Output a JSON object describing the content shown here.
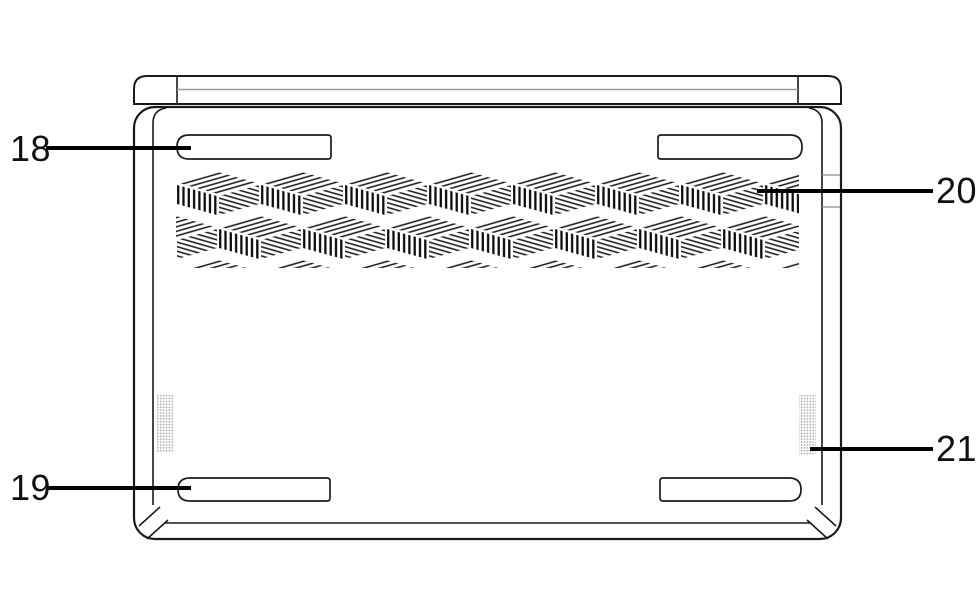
{
  "diagram": {
    "callouts": [
      {
        "label": "18"
      },
      {
        "label": "19"
      },
      {
        "label": "20"
      },
      {
        "label": "21"
      }
    ],
    "colors": {
      "outline": "#1a1a1a",
      "leader_line": "#000000",
      "lid_seam_gray": "#999999",
      "edge_tick_gray": "#8c8c8c",
      "speaker_dot_gray": "#a8a8a8",
      "background": "#ffffff"
    }
  }
}
